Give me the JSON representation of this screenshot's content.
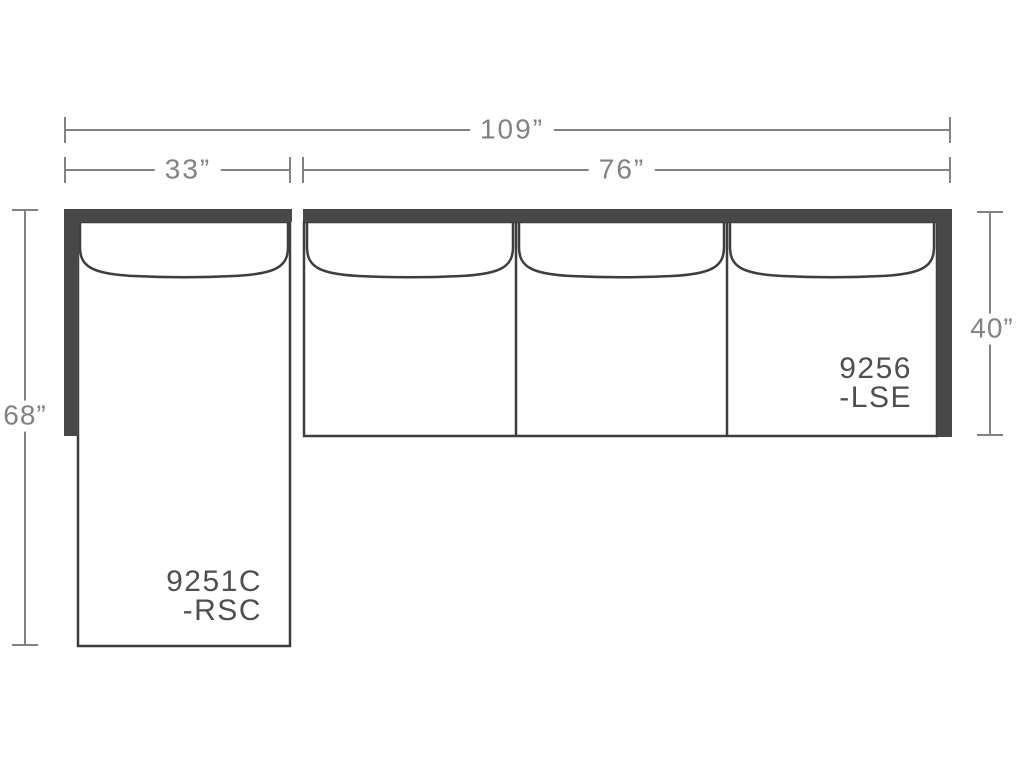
{
  "diagram": {
    "background_color": "#ffffff",
    "colors": {
      "frame_fill": "#484848",
      "outline_stroke": "#3e3e3e",
      "dimension_gray": "#828282",
      "label_gray": "#4f4f4f"
    },
    "dimensions": {
      "total_width": "109”",
      "chaise_width": "33”",
      "sofa_width": "76”",
      "chaise_depth": "68”",
      "sofa_depth": "40”"
    },
    "pieces": [
      {
        "role": "chaise",
        "code": "9251C",
        "suffix": "-RSC",
        "seat_cushions": 1
      },
      {
        "role": "sofa",
        "code": "9256",
        "suffix": "-LSE",
        "seat_cushions": 3
      }
    ]
  }
}
